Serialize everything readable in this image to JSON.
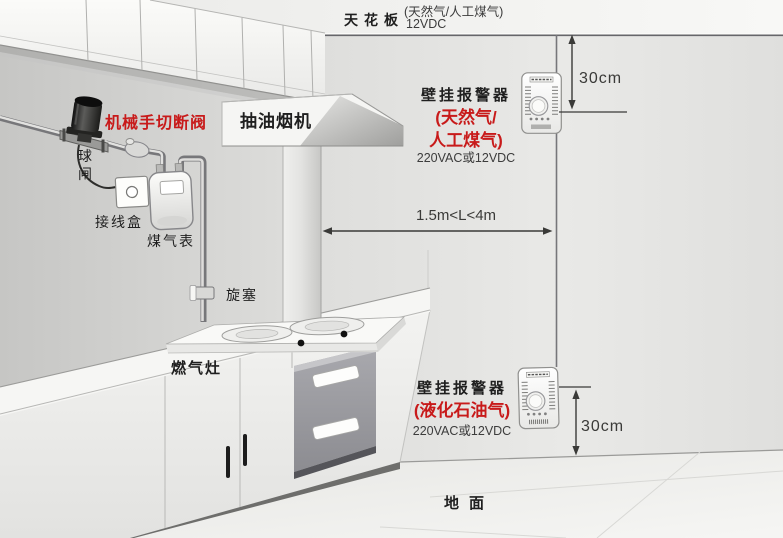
{
  "colors": {
    "red_label": "#c81a1a",
    "text_dark": "#1f1f1f",
    "text_gray": "#3c3c3c",
    "dim_line": "#3a3a38"
  },
  "ceiling": {
    "label": "天花板",
    "fuel_note": "(天然气/人工煤气)",
    "voltage": "12VDC"
  },
  "floor": {
    "label": "地面"
  },
  "alarms": {
    "top": {
      "title": "壁挂报警器",
      "fuel_line1": "(天然气/",
      "fuel_line2": "人工煤气)",
      "power": "220VAC或12VDC",
      "ceiling_distance": "30cm"
    },
    "bottom": {
      "title": "壁挂报警器",
      "fuel": "(液化石油气)",
      "power": "220VAC或12VDC",
      "floor_distance": "30cm"
    }
  },
  "dimensions": {
    "hood_to_alarm": "1.5m<L<4m"
  },
  "equipment": {
    "shutoff_valve": "机械手切断阀",
    "ball_valve": "球闸",
    "junction_box": "接线盒",
    "gas_meter": "煤气表",
    "plug_valve": "旋塞",
    "gas_stove": "燃气灶",
    "range_hood": "抽油烟机"
  }
}
